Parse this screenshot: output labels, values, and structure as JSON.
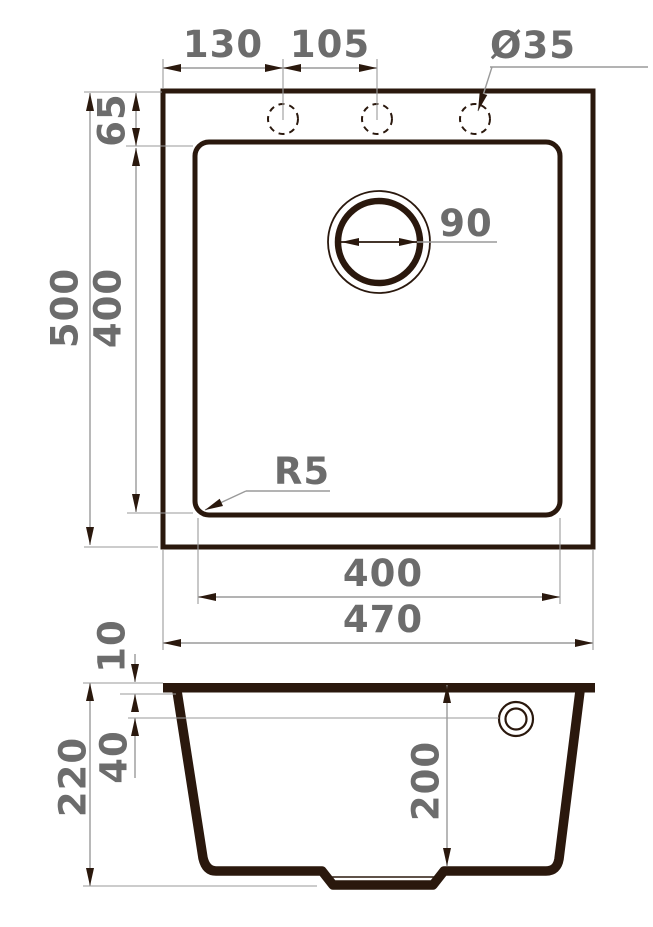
{
  "drawing": {
    "background": "#ffffff",
    "line_color": "#2a180d",
    "dim_line_color": "#9a9a9a",
    "dim_text_color": "#6c6c6c"
  },
  "top_view": {
    "faucet_offset": "130",
    "faucet_spacing": "105",
    "faucet_hole_diameter": "Ø35",
    "rim_to_bowl": "65",
    "overall_length": "500",
    "bowl_length": "400",
    "drain_diameter": "90",
    "corner_radius": "R5",
    "bowl_width": "400",
    "overall_width": "470"
  },
  "section_view": {
    "rim_thickness": "10",
    "overflow_depth": "40",
    "overall_height": "220",
    "bowl_depth": "200"
  }
}
